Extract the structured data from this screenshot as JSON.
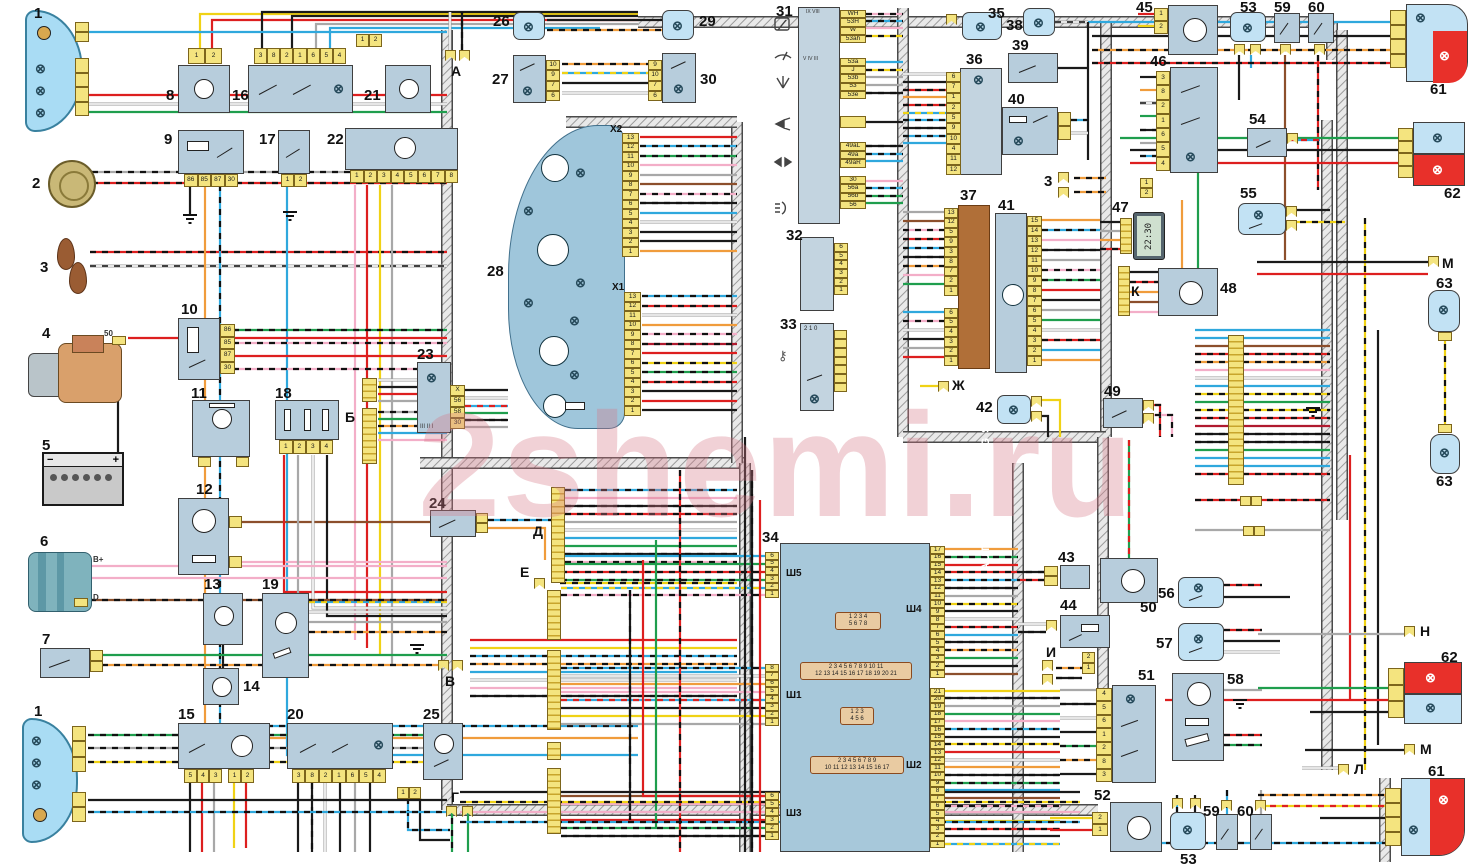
{
  "watermark": "2shemi.ru",
  "texts": {
    "heating_system": "AUTOMATIC HEATING SYSTEM",
    "clock_time": "22:30",
    "ignition_positions": "2 1 0",
    "roman_23": "III II I",
    "roman_31_top": "IX VIII",
    "roman_31_low": "V IV III",
    "starter_terminal": "50",
    "generator_bplus": "B+",
    "generator_d": "D",
    "battery_plus": "+",
    "battery_minus": "−"
  },
  "nums": {
    "c1t": "1",
    "c2": "2",
    "c3": "3",
    "c4": "4",
    "c5": "5",
    "c6": "6",
    "c7": "7",
    "c1b": "1",
    "c3r": "3",
    "c8": "8",
    "c9": "9",
    "c10": "10",
    "c11": "11",
    "c12": "12",
    "c13": "13",
    "c14": "14",
    "c15": "15",
    "c16": "16",
    "c17": "17",
    "c18": "18",
    "c19": "19",
    "c20": "20",
    "c21": "21",
    "c22": "22",
    "c23": "23",
    "c24": "24",
    "c25": "25",
    "c26": "26",
    "c27": "27",
    "c28": "28",
    "c29": "29",
    "c30": "30",
    "c31": "31",
    "c32": "32",
    "c33": "33",
    "c34": "34",
    "c35": "35",
    "c36": "36",
    "c37": "37",
    "c38": "38",
    "c39": "39",
    "c40": "40",
    "c41": "41",
    "c42": "42",
    "c43": "43",
    "c44": "44",
    "c45": "45",
    "c46": "46",
    "c47": "47",
    "c48": "48",
    "c49": "49",
    "c50": "50",
    "c51": "51",
    "c52": "52",
    "c53t": "53",
    "c53b": "53",
    "c54": "54",
    "c55": "55",
    "c56": "56",
    "c57": "57",
    "c58": "58",
    "c59t": "59",
    "c59b": "59",
    "c60t": "60",
    "c60b": "60",
    "c61t": "61",
    "c61b": "61",
    "c62t": "62",
    "c62b": "62",
    "c63a": "63",
    "c63b": "63"
  },
  "points": {
    "a": "А",
    "b": "Б",
    "v": "В",
    "g": "Г",
    "d": "Д",
    "e": "Е",
    "zh": "Ж",
    "i": "И",
    "k": "К",
    "l": "Л",
    "m": "М",
    "n": "Н"
  },
  "sh": {
    "sh5": "Ш5",
    "sh1": "Ш1",
    "sh3": "Ш3",
    "sh4": "Ш4",
    "sh2": "Ш2",
    "x1": "X1",
    "x2": "X2"
  },
  "pins": {
    "p8": [
      "1",
      "2"
    ],
    "p16": [
      "3",
      "8",
      "2",
      "1",
      "6",
      "5",
      "4"
    ],
    "p21": [
      "1",
      "2"
    ],
    "p9": [
      "86",
      "85",
      "87",
      "30"
    ],
    "p17": [
      "1",
      "2"
    ],
    "p22": [
      "1",
      "2",
      "3",
      "4",
      "5",
      "6",
      "7",
      "8"
    ],
    "p10": [
      "86",
      "85",
      "87",
      "30"
    ],
    "p18": [
      "1",
      "2",
      "3",
      "4"
    ],
    "p23": [
      "X",
      "56",
      "58",
      "30"
    ],
    "p15a": [
      "5",
      "4",
      "3"
    ],
    "p15b": [
      "1",
      "2"
    ],
    "p20": [
      "3",
      "8",
      "2",
      "1",
      "6",
      "5",
      "4"
    ],
    "p25": [
      "1",
      "2"
    ],
    "p27": [
      "10",
      "9",
      "7",
      "6"
    ],
    "p30": [
      "9",
      "10",
      "7",
      "6"
    ],
    "px2": [
      "13",
      "12",
      "11",
      "10",
      "9",
      "8",
      "7",
      "6",
      "5",
      "4",
      "3",
      "2",
      "1"
    ],
    "px1": [
      "13",
      "12",
      "11",
      "10",
      "9",
      "8",
      "7",
      "6",
      "5",
      "4",
      "3",
      "2",
      "1"
    ],
    "p31a": [
      "WH",
      "53H",
      "W",
      "53ah"
    ],
    "p31b": [
      "53a",
      "J",
      "53b",
      "53",
      "53e"
    ],
    "p31c": [
      "49aL",
      "49a",
      "49aR"
    ],
    "p31d": [
      "30",
      "56a",
      "56b",
      "56"
    ],
    "p32": [
      "6",
      "5",
      "4",
      "3",
      "2",
      "1"
    ],
    "p36": [
      "6",
      "7",
      "1",
      "2",
      "5",
      "9",
      "10",
      "4",
      "11",
      "12"
    ],
    "p37a": [
      "13",
      "12",
      "5",
      "9",
      "3",
      "8",
      "7",
      "2",
      "1"
    ],
    "p37b": [
      "6",
      "5",
      "4",
      "3",
      "2",
      "1"
    ],
    "p41": [
      "15",
      "14",
      "13",
      "12",
      "11",
      "10",
      "9",
      "8",
      "7",
      "6",
      "5",
      "4",
      "3",
      "2",
      "1"
    ],
    "p45": [
      "1",
      "2"
    ],
    "p46": [
      "3",
      "8",
      "2",
      "1",
      "6",
      "5",
      "4"
    ],
    "p46b": [
      "1",
      "2"
    ],
    "p51": [
      "4",
      "5",
      "6",
      "1",
      "2",
      "8",
      "3"
    ],
    "p52": [
      "2",
      "1"
    ],
    "pI": [
      "2",
      "1"
    ],
    "psh5": [
      "6",
      "5",
      "4",
      "3",
      "2",
      "1"
    ],
    "psh1": [
      "8",
      "7",
      "6",
      "5",
      "4",
      "3",
      "2",
      "1"
    ],
    "psh3": [
      "6",
      "5",
      "4",
      "3",
      "2",
      "1"
    ],
    "psh4": [
      "17",
      "16",
      "15",
      "14",
      "13",
      "12",
      "11",
      "10",
      "9",
      "8",
      "7",
      "6",
      "5",
      "4",
      "3",
      "2",
      "1"
    ],
    "psh2": [
      "21",
      "20",
      "19",
      "18",
      "17",
      "16",
      "15",
      "14",
      "13",
      "12",
      "11",
      "10",
      "9",
      "8",
      "7",
      "6",
      "5",
      "4",
      "3",
      "2",
      "1"
    ]
  },
  "plugs": {
    "p1": [
      "1 2 3 4",
      "5 6 7 8"
    ],
    "p2": [
      "2 3 4 5 6 7 8 9 10 11",
      "12 13 14 15 16 17 18 19 20 21"
    ],
    "p3": [
      "1 2 3",
      "4 5 6"
    ],
    "p4": [
      "2 3 4 5 6 7 8 9",
      "10 11 12 13 14 15 16 17"
    ]
  }
}
